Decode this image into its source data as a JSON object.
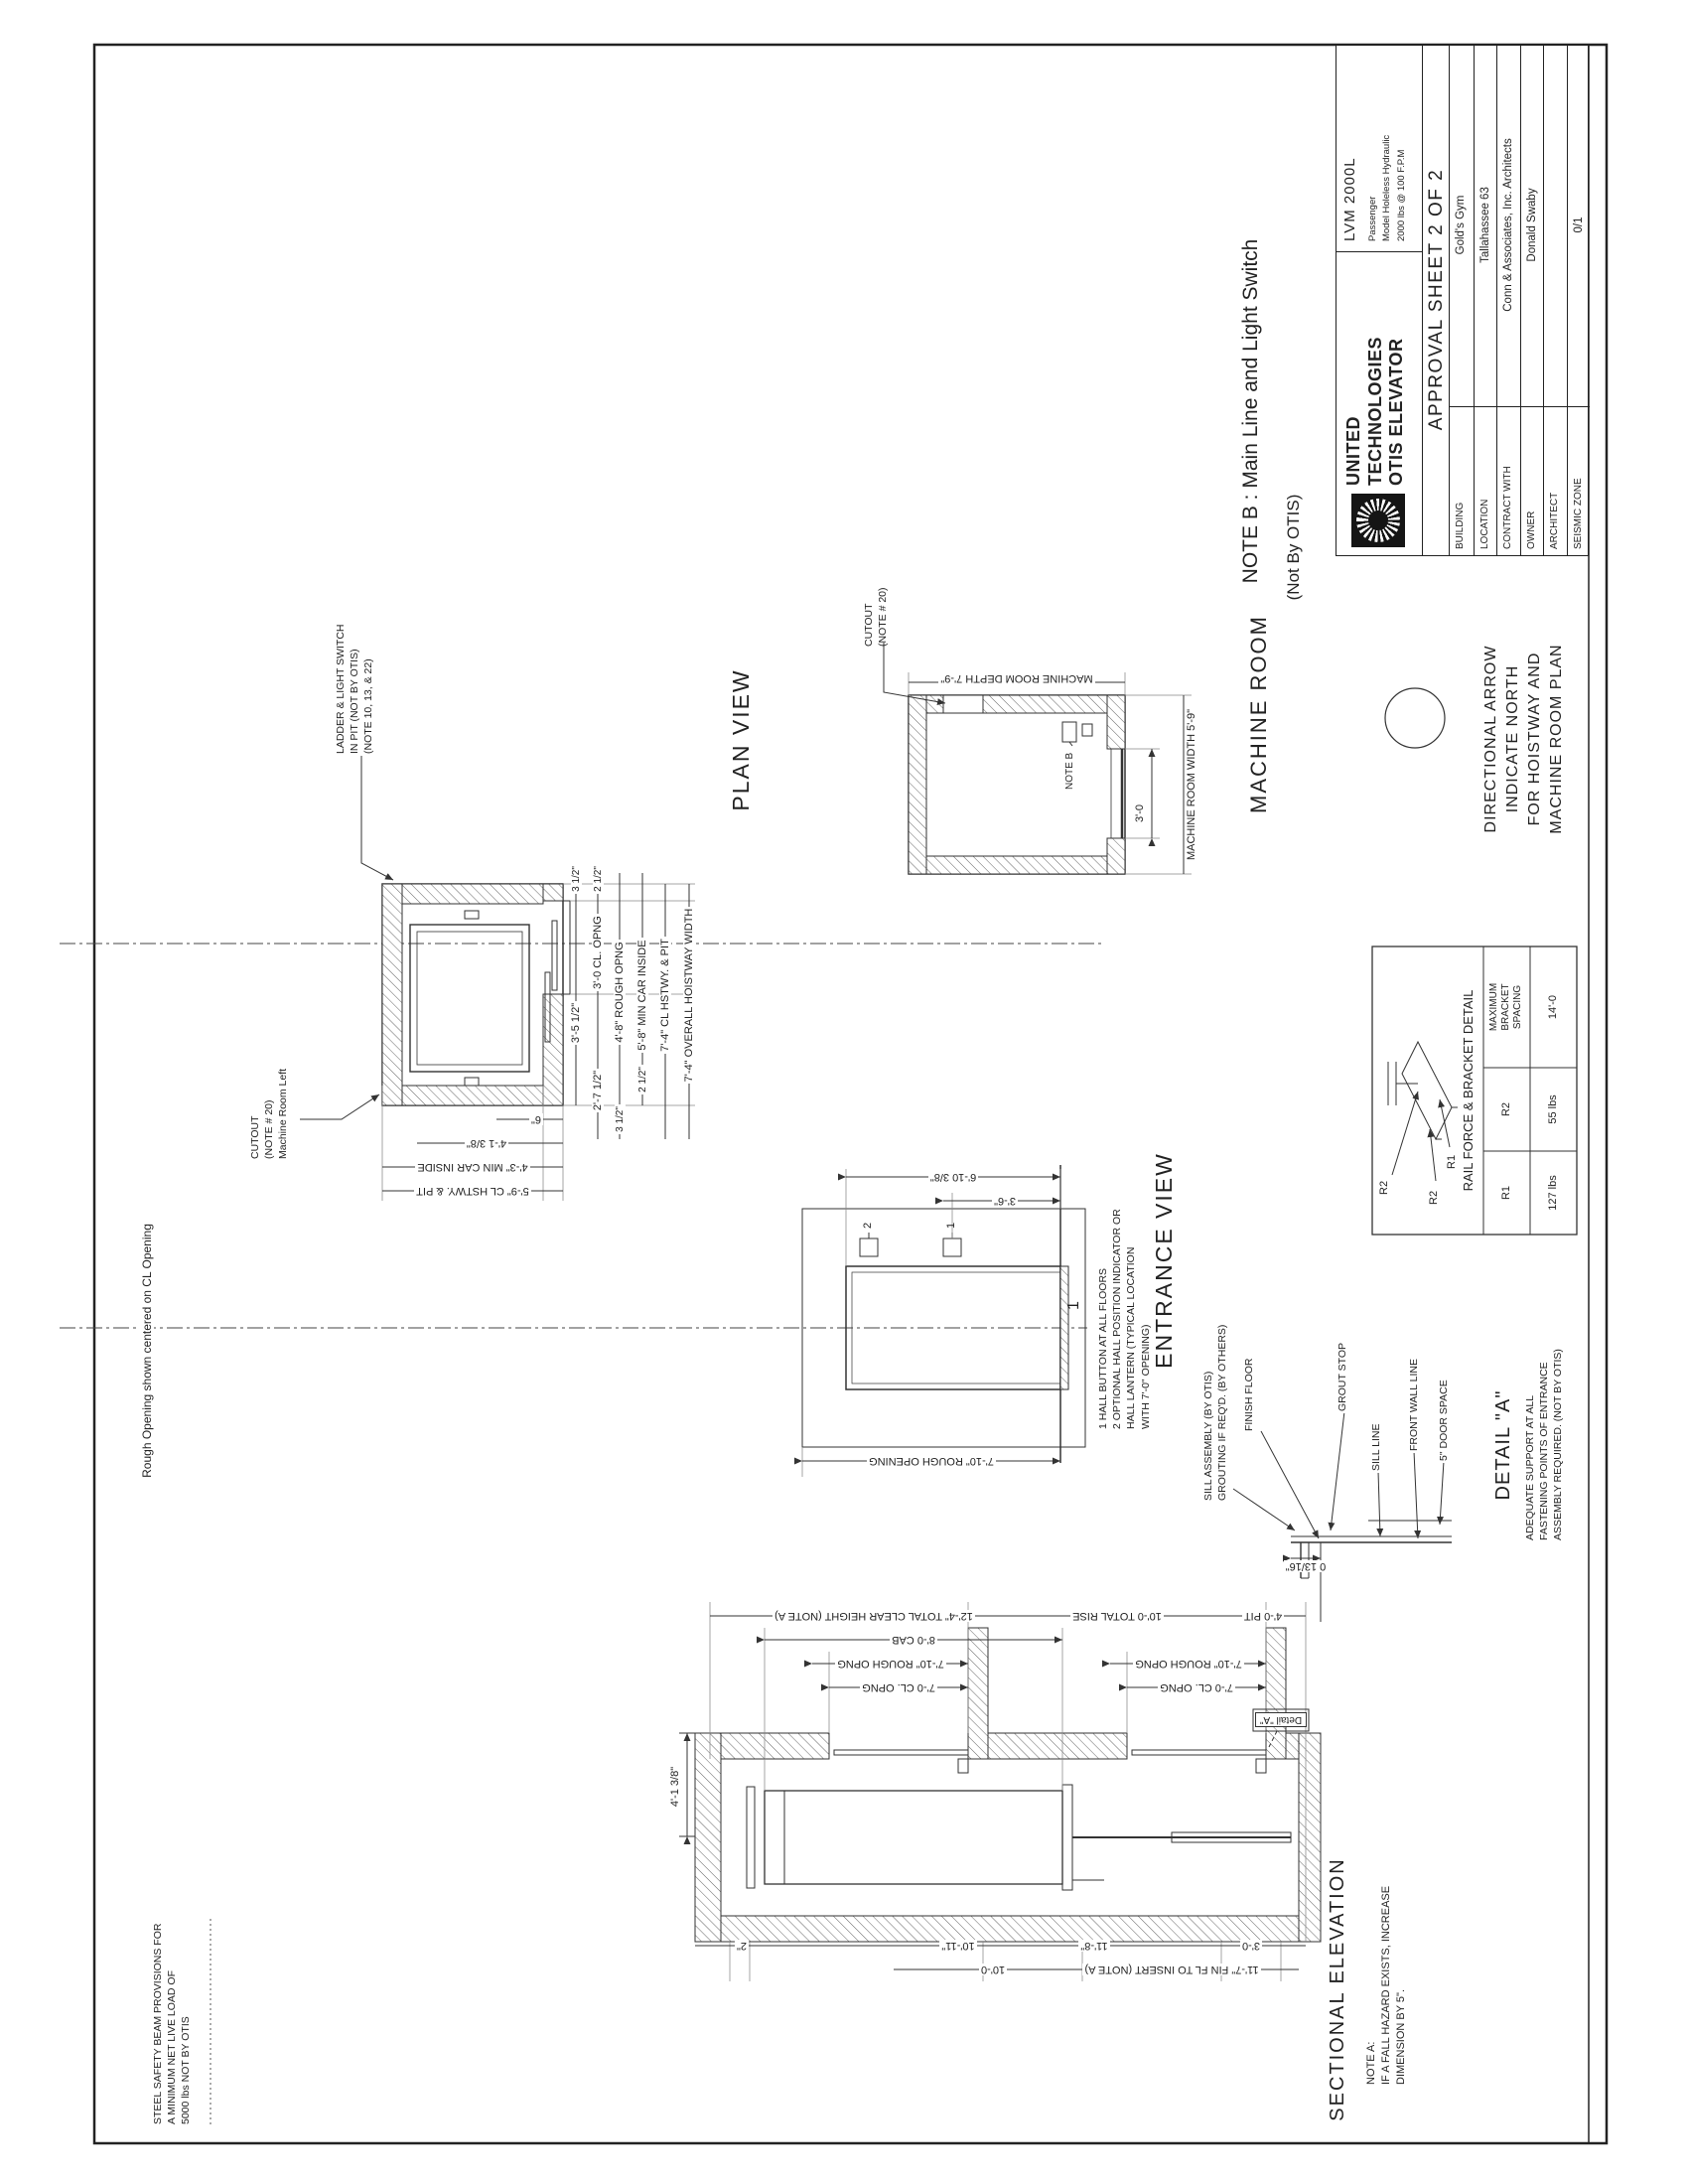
{
  "sheet": {
    "note_b_line1": "NOTE B : Main Line and Light Switch",
    "note_b_line2": "(Not By OTIS)",
    "rough_opening_cl": "Rough Opening shown centered on CL Opening",
    "steel_note": [
      "STEEL SAFETY BEAM PROVISIONS FOR",
      "A MINIMUM NET LIVE LOAD OF",
      "5000 lbs  NOT BY OTIS"
    ]
  },
  "title_block": {
    "company_lines": [
      "UNITED",
      "TECHNOLOGIES",
      "OTIS ELEVATOR"
    ],
    "approval": "APPROVAL SHEET 2 OF 2",
    "model": "LVM 2000L",
    "spec_lines": [
      "Passenger",
      "Model Holeless Hydraulic",
      "2000 lbs  @  100 F.P.M"
    ],
    "rows": [
      {
        "label": "BUILDING",
        "value": "Gold's Gym"
      },
      {
        "label": "LOCATION",
        "value": "Tallahassee 63"
      },
      {
        "label": "CONTRACT WITH",
        "value": "Conn & Associates, Inc.  Architects"
      },
      {
        "label": "OWNER",
        "value": "Donald Swaby"
      },
      {
        "label": "ARCHITECT",
        "value": ""
      },
      {
        "label": "SEISMIC ZONE",
        "value": "0/1"
      }
    ]
  },
  "plan": {
    "title": "PLAN VIEW",
    "ladder_note": [
      "LADDER & LIGHT SWITCH",
      "IN PIT (NOT BY OTIS)",
      "(NOTE 10, 13, & 22)"
    ],
    "cutout_note": [
      "CUTOUT",
      "(NOTE # 20)",
      "Machine Room Left"
    ],
    "dims_bottom": [
      "3'-5 1/2\"",
      "3 1/2\"",
      "2'-7 1/2\"",
      "3'-0 CL. OPNG",
      "2 1/2\"",
      "4'-8\" ROUGH OPNG",
      "3 1/2\"",
      "5'-8\" MIN CAR INSIDE",
      "2 1/2\"",
      "7'-4\" CL HSTWY. & PIT",
      "7'-4\" OVERALL HOISTWAY WIDTH"
    ],
    "dims_left": [
      "5'-9\" CL HSTWY. & PIT",
      "4'-3\" MIN CAR INSIDE",
      "4'-1 3/8\"",
      "6\""
    ]
  },
  "machine_room": {
    "title": "MACHINE ROOM",
    "cutout_note": [
      "CUTOUT",
      "(NOTE # 20)"
    ],
    "note_b": "NOTE B",
    "dim_depth": "MACHINE ROOM DEPTH 7'-9\"",
    "dim_width": "MACHINE ROOM WIDTH 5'-9\"",
    "dim_door": "3'-0"
  },
  "directional": [
    "DIRECTIONAL ARROW",
    "INDICATE NORTH",
    "FOR HOISTWAY AND",
    "MACHINE ROOM PLAN"
  ],
  "rail_detail": {
    "title": "RAIL FORCE & BRACKET DETAIL",
    "r1": "R1",
    "r2": "R2",
    "headers": [
      "R1",
      "R2",
      "MAXIMUM BRACKET SPACING"
    ],
    "values": [
      "127 lbs",
      "55 lbs",
      "14'-0"
    ]
  },
  "entrance": {
    "title": "ENTRANCE VIEW",
    "dim_rough": "7'-10\" ROUGH OPENING",
    "dim_indicator": "6'-10 3/8\"",
    "dim_button": "3'-6\"",
    "tag_one": "1",
    "tag_two": "2",
    "floor": "1",
    "notes": [
      "1  HALL BUTTON AT ALL FLOORS",
      "2  OPTIONAL HALL POSITION INDICATOR OR",
      "    HALL LANTERN (TYPICAL LOCATION",
      "    WITH 7'-0\" OPENING)"
    ]
  },
  "detail_a": {
    "title": "DETAIL  \"A\"",
    "note": [
      "ADEQUATE SUPPORT AT ALL",
      "FASTENING POINTS OF ENTRANCE",
      "ASSEMBLY REQUIRED. (NOT BY OTIS)"
    ],
    "sill_l1": "SILL ASSEMBLY (BY OTIS)",
    "sill_l2": "GROUTING IF REQ'D. (BY OTHERS)",
    "finish_floor": "FINISH FLOOR",
    "grout_stop": "GROUT STOP",
    "sill_line": "SILL LINE",
    "front_wall": "FRONT WALL LINE",
    "door_space": "5\" DOOR SPACE",
    "dim": "0 13/16\""
  },
  "elevation": {
    "title": "SECTIONAL ELEVATION",
    "note_a": [
      "NOTE A:",
      "IF A FALL HAZARD EXISTS, INCREASE",
      "DIMENSION BY 5\"."
    ],
    "top_dim": "4'-1 3/8\"",
    "detail_tag": "Detail \"A\"",
    "dim_cl_opng": "7'-0 CL. OPNG",
    "dim_rough_opng": "7'-10\" ROUGH OPNG",
    "dim_cab": "8'-0 CAB",
    "dim_clear": "12'-4\" TOTAL CLEAR HEIGHT (NOTE A)",
    "dim_rise": "10'-0 TOTAL RISE",
    "dim_pit": "4'-0 PIT",
    "dim_2": "2\"",
    "dim_1011": "10'-11\"",
    "dim_118": "11'-8\"",
    "dim_30": "3'-0",
    "dim_100": "10'-0",
    "dim_insert": "11'-7\" FIN FL TO INSERT (NOTE A)"
  }
}
